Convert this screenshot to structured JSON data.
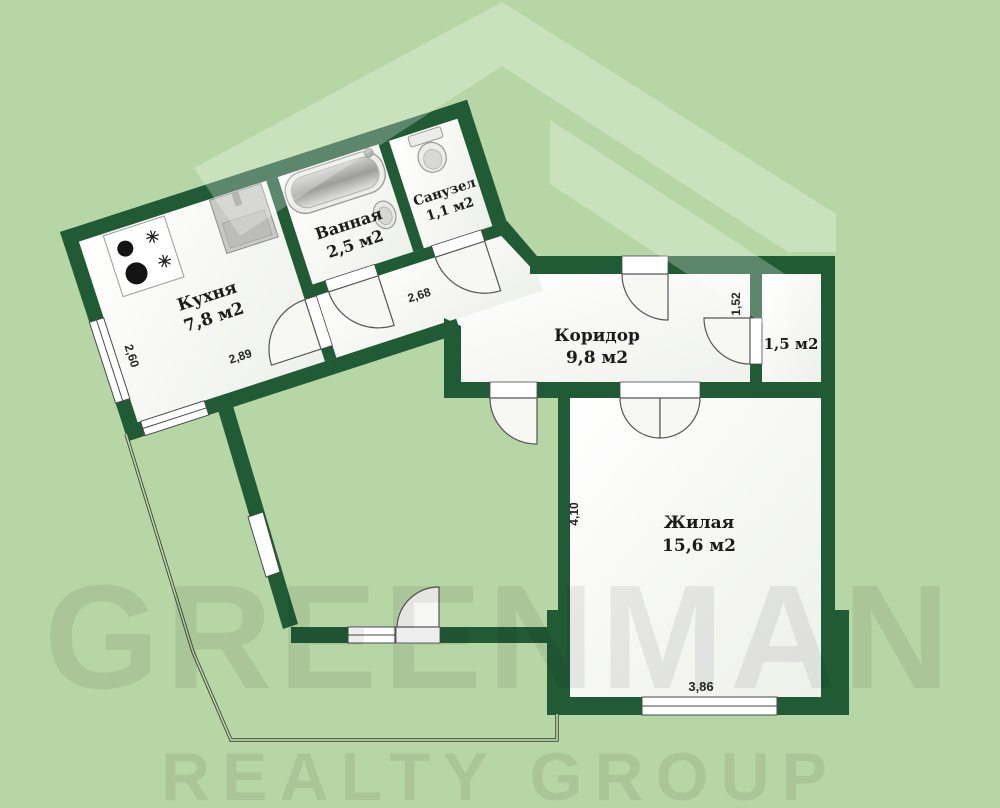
{
  "page": {
    "background": "#b7d6a5"
  },
  "plan": {
    "wall_color": "#215b36",
    "line_color": "#4a4a4a",
    "rooms": [
      {
        "id": "kitchen",
        "name": "Кухня",
        "area": "7,8 м2"
      },
      {
        "id": "bath",
        "name": "Ванная",
        "area": "2,5 м2"
      },
      {
        "id": "wc",
        "name": "Санузел",
        "area": "1,1 м2"
      },
      {
        "id": "corridor",
        "name": "Коридор",
        "area": "9,8 м2"
      },
      {
        "id": "storage",
        "name": "",
        "area": "1,5 м2"
      },
      {
        "id": "living",
        "name": "Жилая",
        "area": "15,6 м2"
      }
    ],
    "dimensions": {
      "kitchen_side": "2,60",
      "kitchen_bottom": "2,89",
      "hallway": "2,68",
      "storage_side": "1,52",
      "living_side": "4,10",
      "living_bottom": "3,86"
    }
  },
  "watermark": {
    "brand_top": "GREENMAN",
    "brand_bottom": "REALTY GROUP",
    "logo_color": "#ffffff"
  }
}
